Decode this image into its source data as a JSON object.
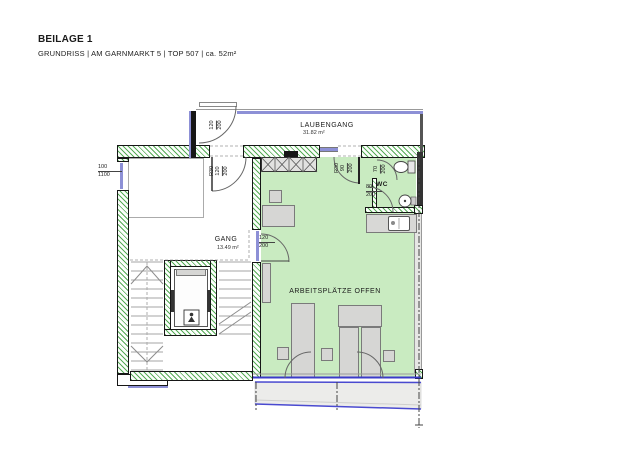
{
  "header": {
    "title": "BEILAGE 1",
    "subtitle": "GRUNDRISS | AM GARNMARKT 5 | TOP 507 | ca. 52m²"
  },
  "rooms": {
    "laubengang": {
      "name": "LAUBENGANG",
      "area": "31.82 m²"
    },
    "gang": {
      "name": "GANG",
      "area": "13.49 m²"
    },
    "workspace": {
      "name": "ARBEITSPLÄTZE OFFEN"
    },
    "wc": {
      "name": "WC"
    }
  },
  "dims": {
    "balcony_gate": {
      "num": "120",
      "den": "200"
    },
    "entry_door": {
      "fire": "R30",
      "num": "120",
      "den": "200"
    },
    "left_window": {
      "num": "100",
      "den": "1100"
    },
    "hall_door": {
      "num": "120",
      "den": "200"
    },
    "side_entry_door": {
      "fire": "R30",
      "num": "90",
      "den": "200"
    },
    "wc_door": {
      "num": "70",
      "den": "200"
    },
    "vestibule_door": {
      "num": "80",
      "den": "200"
    }
  },
  "colors": {
    "glazing_lavender": "#8d90d6",
    "window_blue": "#3b3bc9",
    "room_green_fill": "#c9ebc1",
    "wall_hatch_green": "#57ac57",
    "wall_black": "#161616",
    "furniture_gray": "#d6d6d4",
    "terrace_gray": "#ececea"
  }
}
